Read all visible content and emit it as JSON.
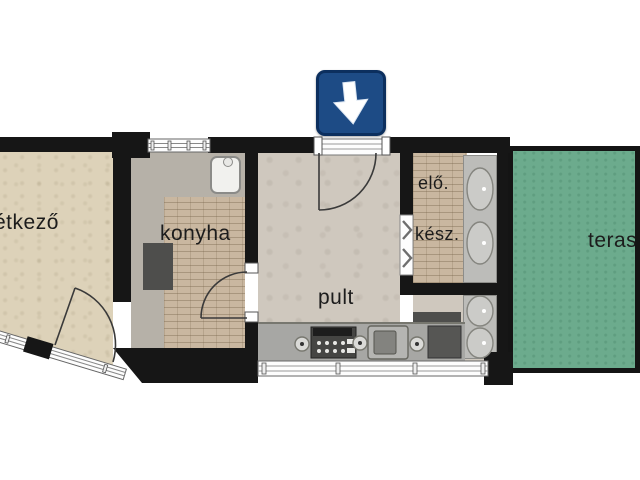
{
  "diagram_type": "apartment-floor-plan",
  "rooms": {
    "etkezo": {
      "label": "étkező"
    },
    "konyha": {
      "label": "konyha"
    },
    "pult": {
      "label": "pult"
    },
    "elo": {
      "label": "elő."
    },
    "kesz": {
      "label": "kész."
    },
    "terasz": {
      "label": "terasz"
    }
  },
  "entrance": {
    "icon": "down-arrow-icon",
    "meaning": "entrance direction"
  },
  "fixtures": [
    "kitchen-sink",
    "stove",
    "counter-sink",
    "fridge",
    "wash-basin",
    "wash-basin",
    "wash-basin",
    "wash-basin",
    "shower"
  ],
  "colors": {
    "wall": "#161616",
    "etkezo-floor": "#ddd2b9",
    "konyha-floor": "#b6b1a8",
    "brick": "#c9b7a0",
    "pult-floor": "#cfc8be",
    "vanity": "#bcbcb9",
    "counter": "#a7a7a4",
    "terrace": "#6cab8d",
    "sign-blue": "#1d4b85",
    "sign-border": "#0c2f5e",
    "appliance-dark": "#4e4e4c",
    "text": "#1c1c1c"
  }
}
